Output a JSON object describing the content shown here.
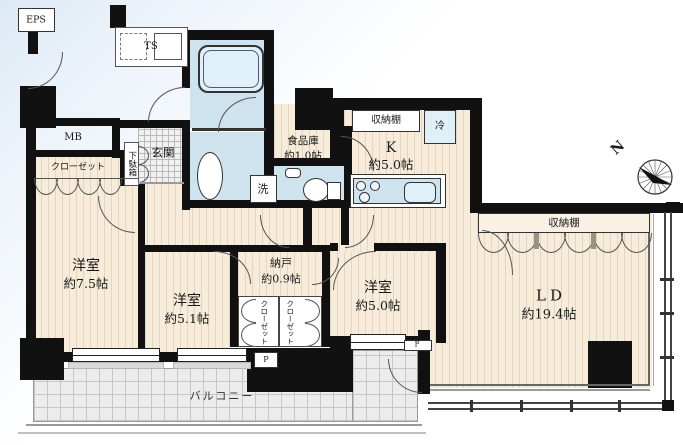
{
  "plan": {
    "utilities": {
      "eps": "EPS",
      "ts": "TS",
      "mb": "MB",
      "pipe_left": "P",
      "pipe_right": "P",
      "fridge": "冷",
      "laundry": "洗"
    },
    "entrance": {
      "genkan": "玄関",
      "shoe_cabinet": "下駄箱"
    },
    "rooms": {
      "bedroom_main": {
        "name": "洋室",
        "size": "約7.5帖"
      },
      "bedroom_mid": {
        "name": "洋室",
        "size": "約5.1帖"
      },
      "bedroom_right": {
        "name": "洋室",
        "size": "約5.0帖"
      },
      "storage_nando": {
        "name": "納戸",
        "size": "約0.9帖"
      },
      "living_dining": {
        "name": "LD",
        "size": "約19.4帖"
      },
      "kitchen": {
        "name": "K",
        "size": "約5.0帖"
      },
      "pantry": {
        "name": "食品庫",
        "size": "約1.0帖"
      }
    },
    "closets": {
      "main": "クローゼット",
      "left": "クローゼット",
      "right": "クローゼット"
    },
    "shelves": {
      "kitchen": "収納棚",
      "living": "収納棚"
    },
    "balcony": {
      "label": "バルコニー"
    },
    "compass": {
      "north": "N"
    },
    "colors": {
      "wall": "#111111",
      "floor": "#f6ecd9",
      "wet": "#cfe3ef",
      "balcony_tile": "#ececec"
    }
  }
}
